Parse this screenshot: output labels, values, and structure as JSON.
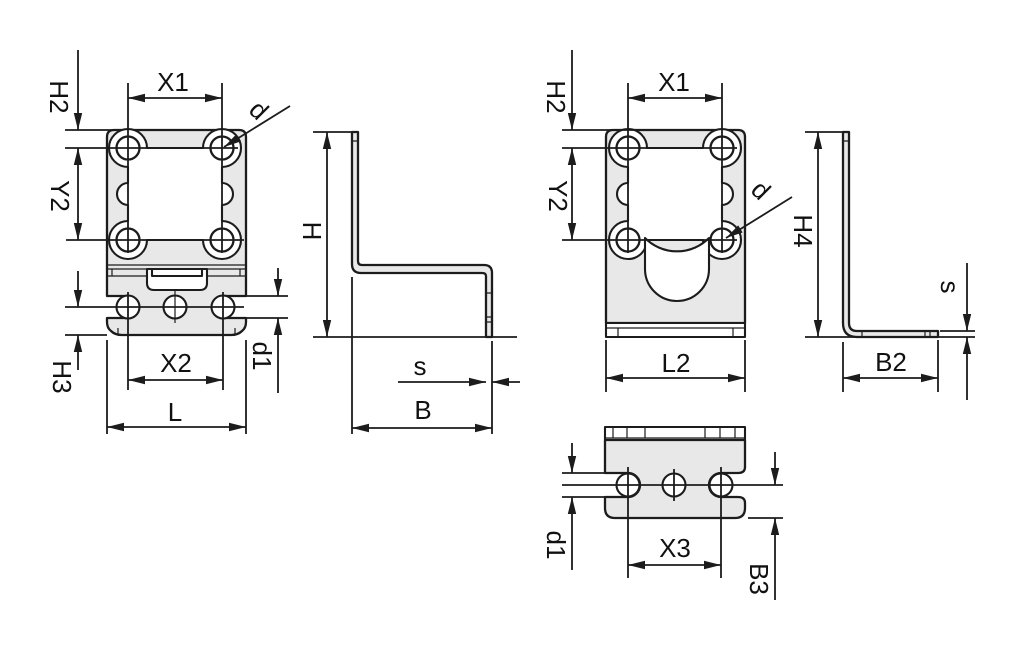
{
  "drawing": {
    "type": "technical-dimension-drawing",
    "colors": {
      "part_fill": "#e8e8e8",
      "line_color": "#1c1c1c",
      "background": "#ffffff",
      "text_color": "#111111"
    },
    "views": {
      "front_view_left": {
        "labels": {
          "H2": "H2",
          "X1": "X1",
          "d": "d",
          "Y2": "Y2",
          "H3": "H3",
          "X2": "X2",
          "L": "L",
          "d1": "d1"
        }
      },
      "side_view_left": {
        "labels": {
          "H": "H",
          "s": "s",
          "B": "B"
        }
      },
      "front_view_right": {
        "labels": {
          "H2": "H2",
          "X1": "X1",
          "Y2": "Y2",
          "d": "d",
          "L2": "L2"
        }
      },
      "side_view_right": {
        "labels": {
          "H4": "H4",
          "s": "s",
          "B2": "B2"
        }
      },
      "top_view": {
        "labels": {
          "d1": "d1",
          "X3": "X3",
          "B3": "B3"
        }
      }
    }
  }
}
